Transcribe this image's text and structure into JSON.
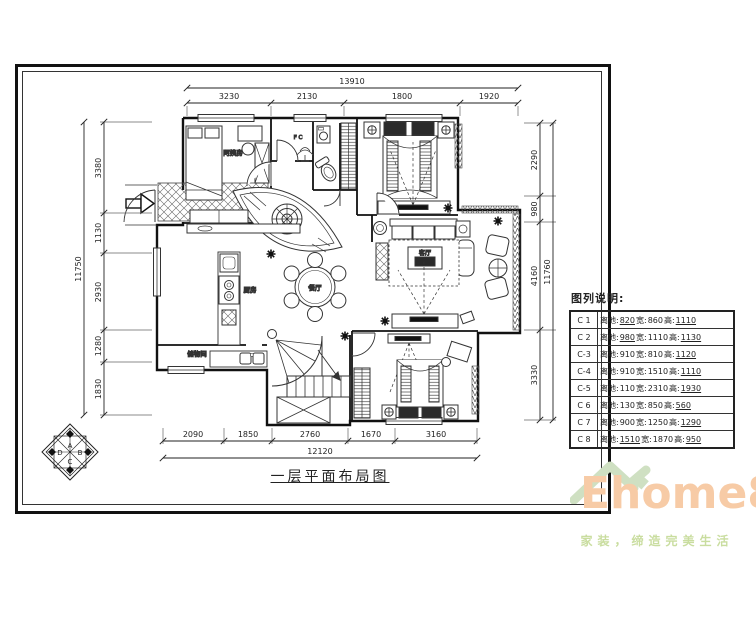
{
  "drawing": {
    "title": "一层平面布局图"
  },
  "dimensions": {
    "top": {
      "total": "13910",
      "segments": [
        "3230",
        "2130",
        "1800",
        "1920"
      ]
    },
    "bottom": {
      "total": "12120",
      "segments": [
        "2090",
        "1850",
        "2760",
        "1670",
        "3160"
      ]
    },
    "left": {
      "total": "11750",
      "segments": [
        "3380",
        "1130",
        "2930",
        "1280",
        "1830"
      ]
    },
    "right": {
      "total": "11760",
      "segments": [
        "2290",
        "980",
        "4160",
        "3330"
      ]
    }
  },
  "rooms": {
    "bedroom_nanny": "阿姨房",
    "kitchen": "厨房",
    "dining": "餐厅",
    "living": "客厅",
    "storage": "储物间",
    "hall_note": "F C"
  },
  "legend": {
    "title": "图列说明:",
    "field_ground": "离地:",
    "field_width": "宽:",
    "field_height": "高:",
    "rows": [
      {
        "id": "C 1",
        "ground": "820",
        "width": "860",
        "height": "1110"
      },
      {
        "id": "C 2",
        "ground": "980",
        "width": "1110",
        "height": "1130"
      },
      {
        "id": "C-3",
        "ground": "910",
        "width": "810",
        "height": "1120"
      },
      {
        "id": "C-4",
        "ground": "910",
        "width": "1510",
        "height": "1110"
      },
      {
        "id": "C-5",
        "ground": "110",
        "width": "2310",
        "height": "1930"
      },
      {
        "id": "C 6",
        "ground": "130",
        "width": "850",
        "height": "560"
      },
      {
        "id": "C 7",
        "ground": "900",
        "width": "1250",
        "height": "1290"
      },
      {
        "id": "C 8",
        "ground": "1510",
        "width": "1870",
        "height": "950"
      }
    ]
  },
  "compass": {
    "a": "A",
    "b": "B",
    "c": "C",
    "d": "D"
  },
  "logo": {
    "brand": "Ehome8",
    "tagline": "家装，缔造完美生活",
    "brand_color": "#f7cba6",
    "roof_color": "#cfe0c2",
    "tagline_color": "#c9dd9f"
  }
}
